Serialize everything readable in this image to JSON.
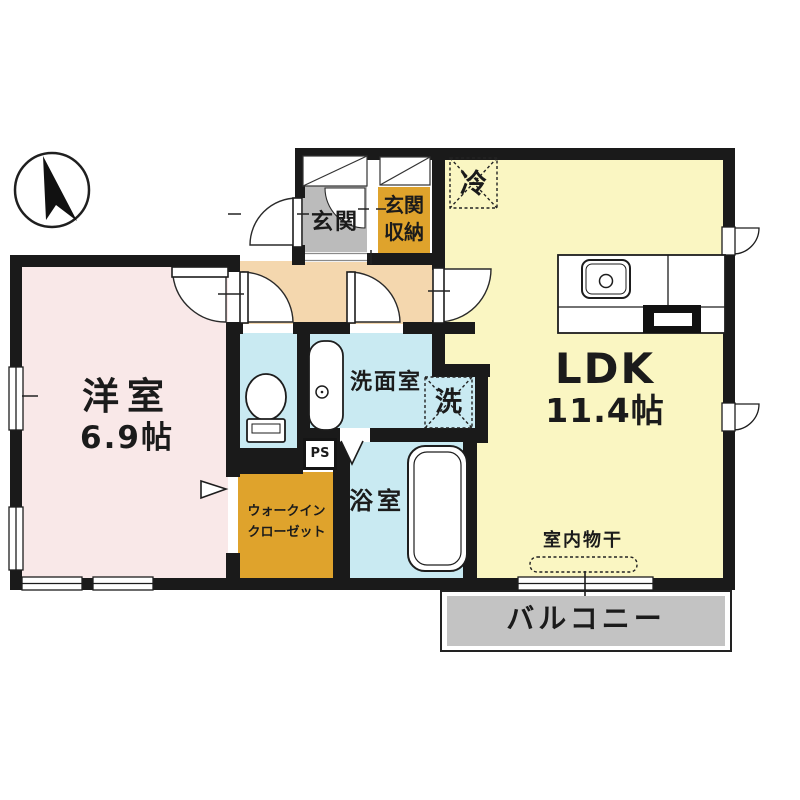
{
  "figure": "apartment-floor-plan",
  "compass": {
    "icon": "north-arrow"
  },
  "colors": {
    "wall": "#1a1a1a",
    "ldk_yellow": "#faf6c2",
    "western_room_pink": "#f9e8e8",
    "hallway_peach": "#f4d7ae",
    "genkan_gray": "#bbbbbb",
    "storage_orange": "#dfa32c",
    "wet_area_blue": "#c9eaf2",
    "balcony_gray": "#c3c3c3"
  },
  "rooms": {
    "genkan": {
      "label": "玄関"
    },
    "genkan_storage": {
      "label": "玄関\n収納"
    },
    "refrigerator_space": {
      "label": "冷"
    },
    "ldk": {
      "name": "LDK",
      "size": "11.4帖"
    },
    "western_room": {
      "name": "洋室",
      "size": "6.9帖"
    },
    "washroom": {
      "label": "洗面室"
    },
    "washer_space": {
      "label": "洗"
    },
    "bathroom": {
      "label": "浴室"
    },
    "pipe_space": {
      "label": "PS"
    },
    "walk_in_closet": {
      "label": "ウォークイン\nクローゼット"
    },
    "indoor_drying": {
      "label": "室内物干"
    },
    "balcony": {
      "label": "バルコニー"
    }
  }
}
